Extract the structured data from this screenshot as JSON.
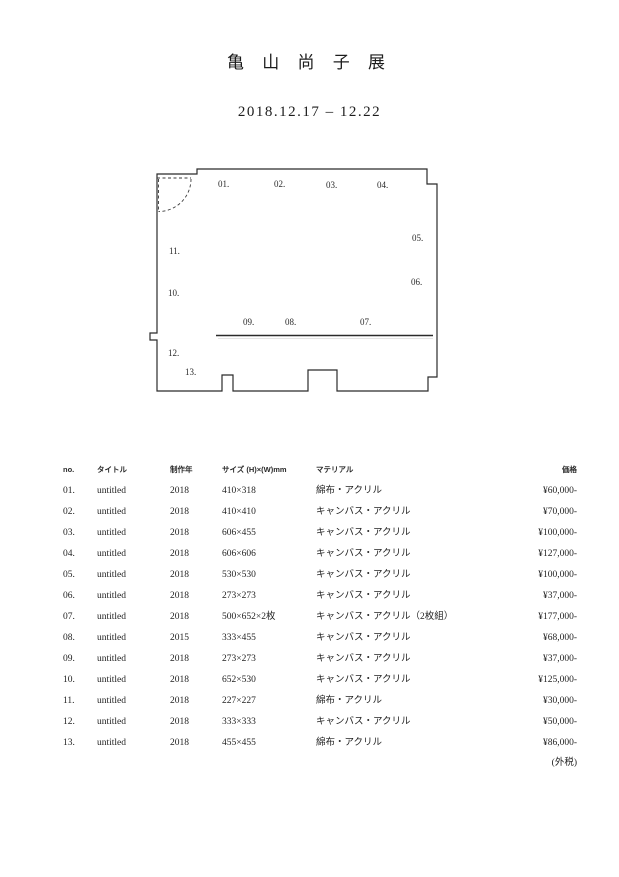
{
  "page": {
    "title": "亀 山 尚 子 展",
    "dates": "2018.12.17 – 12.22",
    "tax_note": "(外税)"
  },
  "plan": {
    "labels": [
      {
        "text": "01."
      },
      {
        "text": "02."
      },
      {
        "text": "03."
      },
      {
        "text": "04."
      },
      {
        "text": "05."
      },
      {
        "text": "06."
      },
      {
        "text": "07."
      },
      {
        "text": "08."
      },
      {
        "text": "09."
      },
      {
        "text": "10."
      },
      {
        "text": "11."
      },
      {
        "text": "12."
      },
      {
        "text": "13."
      }
    ]
  },
  "table": {
    "headers": {
      "no": "no.",
      "title": "タイトル",
      "year": "制作年",
      "size": "サイズ (H)×(W)mm",
      "material": "マテリアル",
      "price": "価格"
    },
    "rows": [
      {
        "no": "01.",
        "title": "untitled",
        "year": "2018",
        "size": "410×318",
        "material": "綿布・アクリル",
        "price": "¥60,000-"
      },
      {
        "no": "02.",
        "title": "untitled",
        "year": "2018",
        "size": "410×410",
        "material": "キャンバス・アクリル",
        "price": "¥70,000-"
      },
      {
        "no": "03.",
        "title": "untitled",
        "year": "2018",
        "size": "606×455",
        "material": "キャンバス・アクリル",
        "price": "¥100,000-"
      },
      {
        "no": "04.",
        "title": "untitled",
        "year": "2018",
        "size": "606×606",
        "material": "キャンバス・アクリル",
        "price": "¥127,000-"
      },
      {
        "no": "05.",
        "title": "untitled",
        "year": "2018",
        "size": "530×530",
        "material": "キャンバス・アクリル",
        "price": "¥100,000-"
      },
      {
        "no": "06.",
        "title": "untitled",
        "year": "2018",
        "size": "273×273",
        "material": "キャンバス・アクリル",
        "price": "¥37,000-"
      },
      {
        "no": "07.",
        "title": "untitled",
        "year": "2018",
        "size": "500×652×2枚",
        "material": "キャンバス・アクリル（2枚組）",
        "price": "¥177,000-"
      },
      {
        "no": "08.",
        "title": "untitled",
        "year": "2015",
        "size": "333×455",
        "material": "キャンバス・アクリル",
        "price": "¥68,000-"
      },
      {
        "no": "09.",
        "title": "untitled",
        "year": "2018",
        "size": "273×273",
        "material": "キャンバス・アクリル",
        "price": "¥37,000-"
      },
      {
        "no": "10.",
        "title": "untitled",
        "year": "2018",
        "size": "652×530",
        "material": "キャンバス・アクリル",
        "price": "¥125,000-"
      },
      {
        "no": "11.",
        "title": "untitled",
        "year": "2018",
        "size": "227×227",
        "material": "綿布・アクリル",
        "price": "¥30,000-"
      },
      {
        "no": "12.",
        "title": "untitled",
        "year": "2018",
        "size": "333×333",
        "material": "キャンバス・アクリル",
        "price": "¥50,000-"
      },
      {
        "no": "13.",
        "title": "untitled",
        "year": "2018",
        "size": "455×455",
        "material": "綿布・アクリル",
        "price": "¥86,000-"
      }
    ]
  }
}
